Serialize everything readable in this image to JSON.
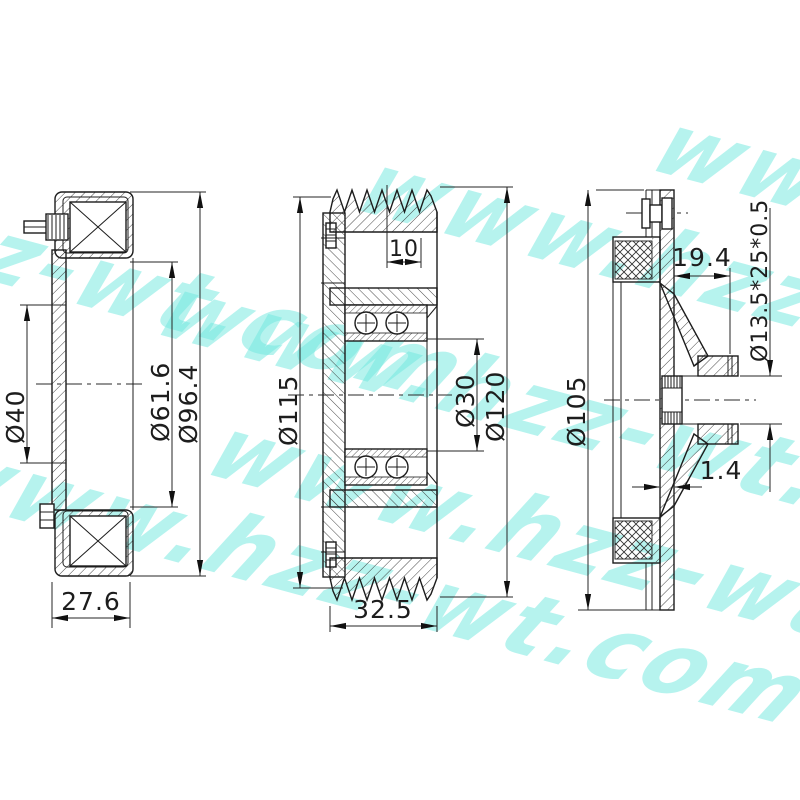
{
  "watermark": {
    "text": "www.hzz-wt.com",
    "color": "#6fe8df"
  },
  "views": {
    "left": {
      "dims": {
        "bore_dia": "Ø40",
        "coil_dia": "Ø61.6",
        "outer_dia": "Ø96.4",
        "width": "27.6"
      }
    },
    "middle": {
      "dims": {
        "groove_offset": "10",
        "pitch_dia": "Ø115",
        "bore_dia": "Ø30",
        "outer_dia": "Ø120",
        "width": "32.5"
      }
    },
    "right": {
      "dims": {
        "hub_depth": "19.4",
        "spline_spec": "Ø13.5*25*0.5",
        "outer_dia": "Ø105",
        "plate_thickness": "1.4"
      }
    }
  }
}
